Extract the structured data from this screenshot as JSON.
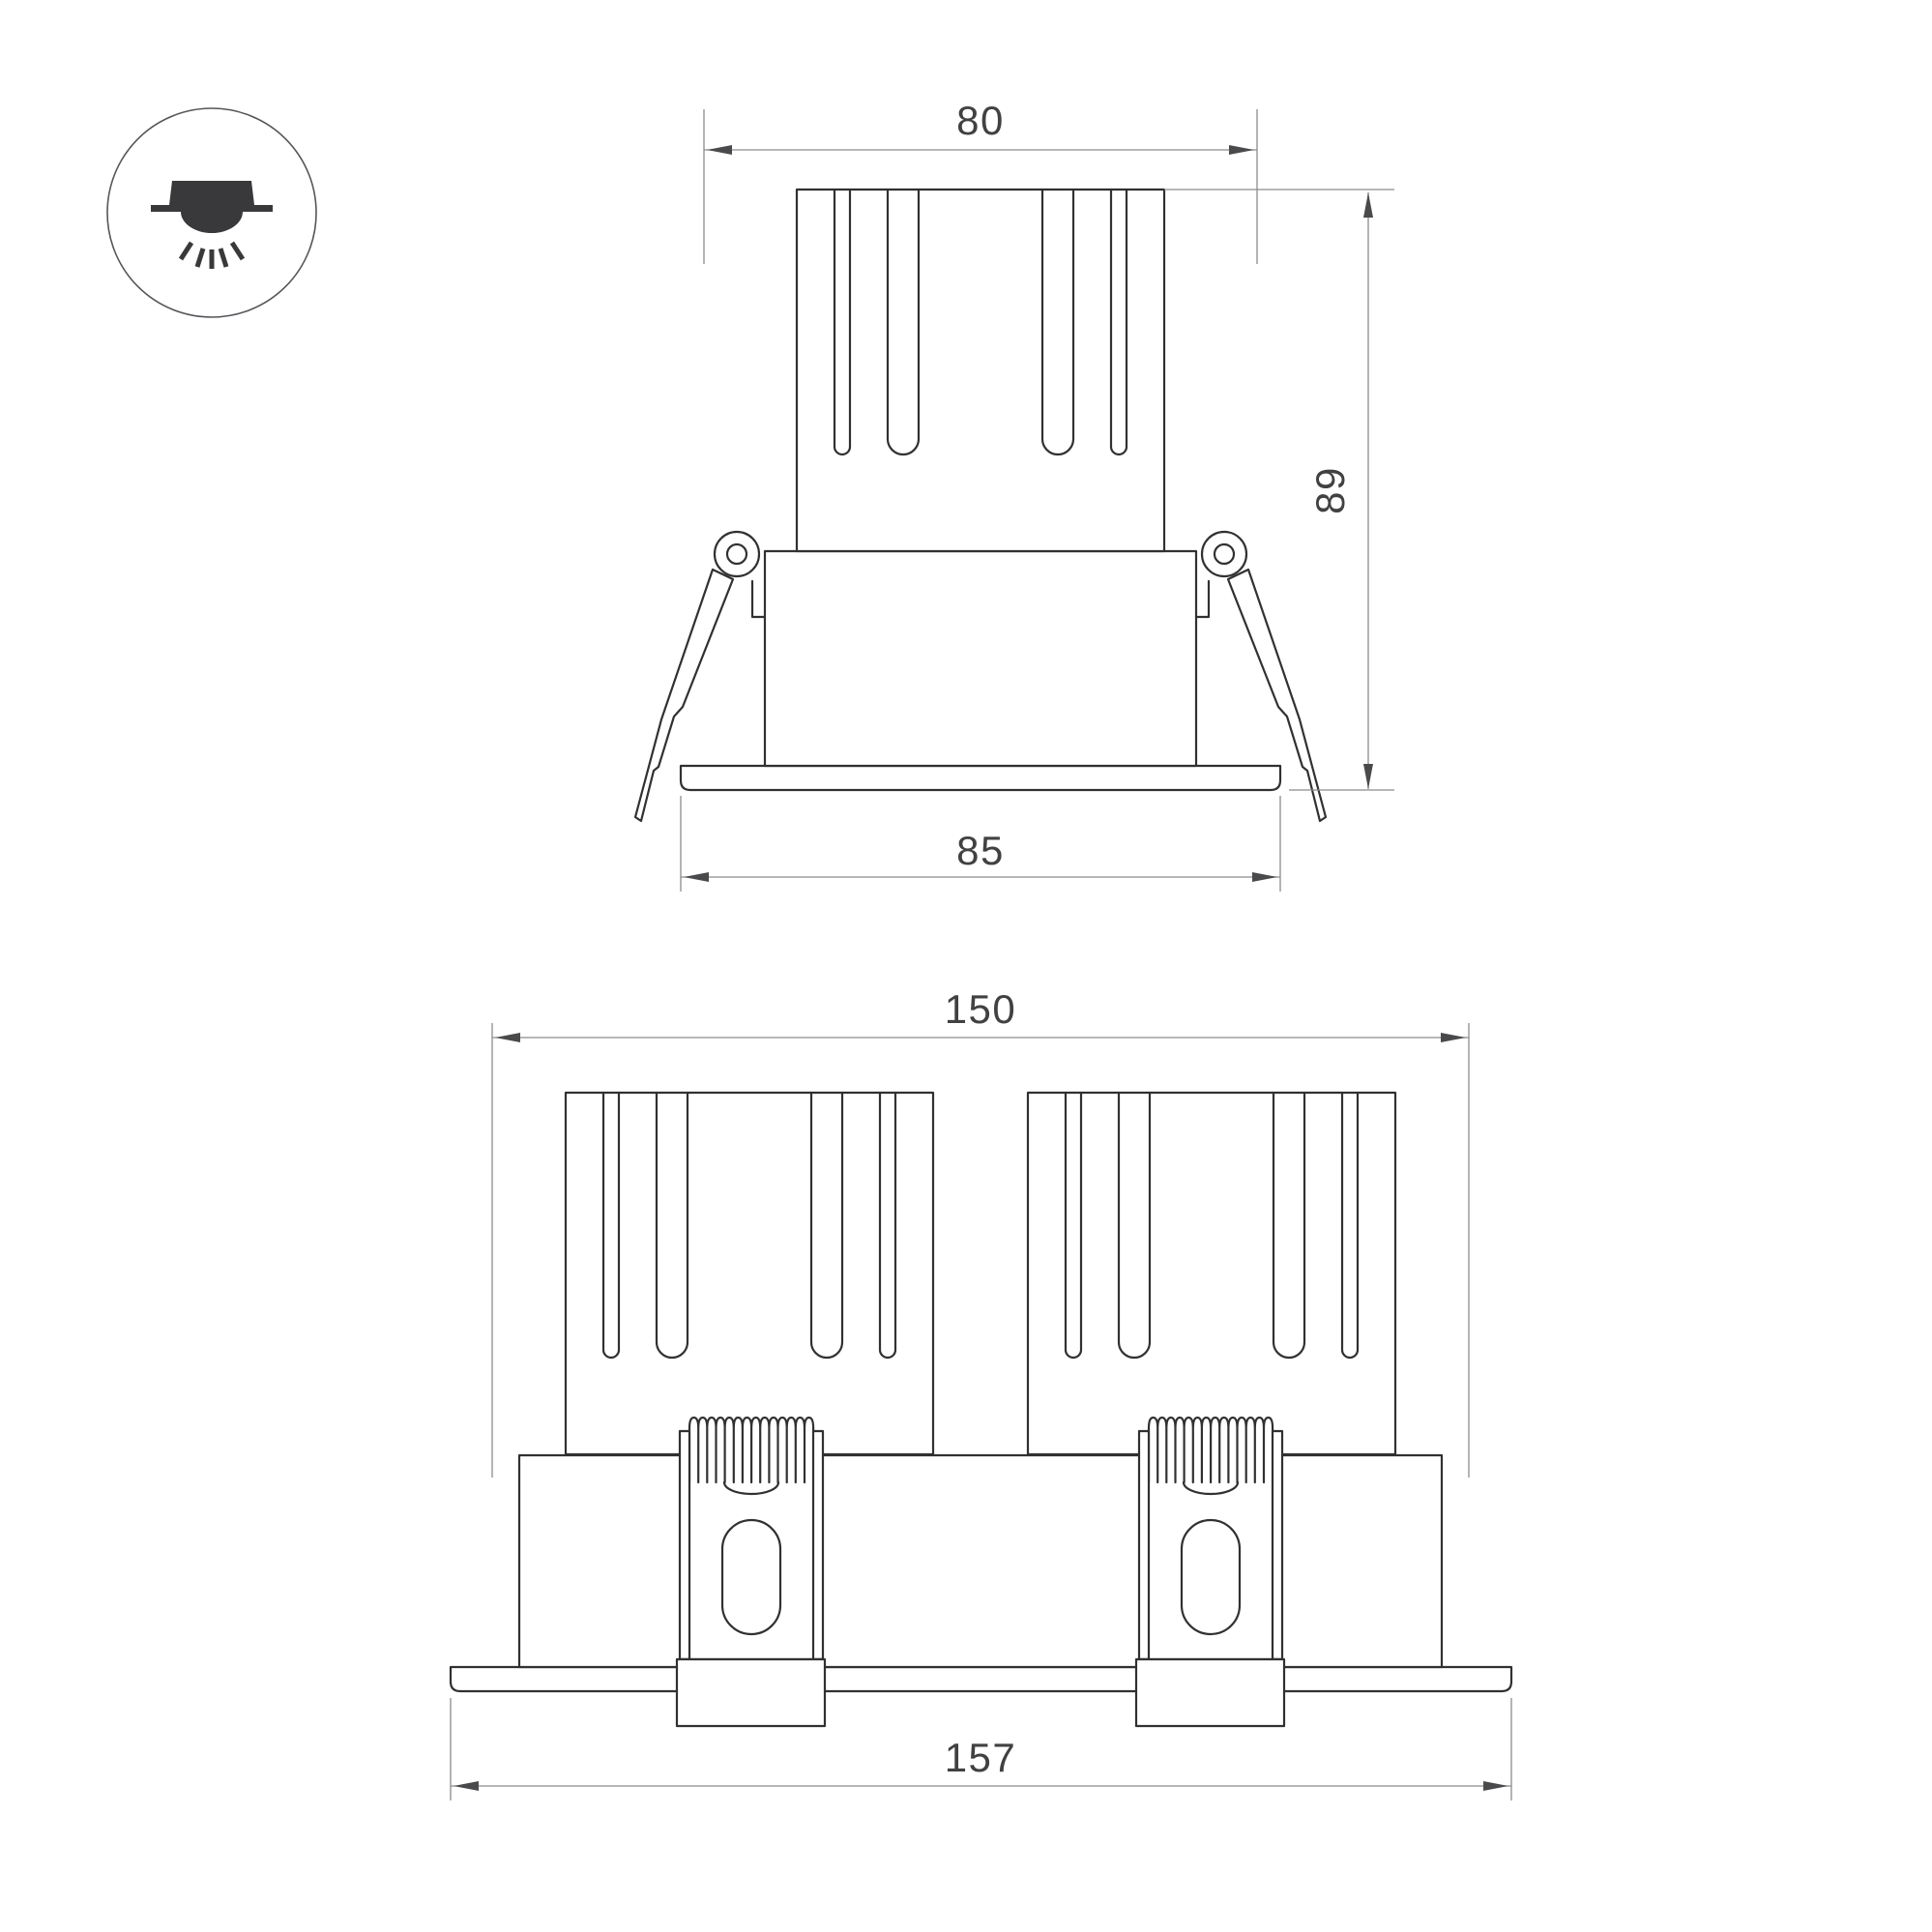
{
  "page": {
    "background": "#ffffff"
  },
  "colors": {
    "object_line": "#313133",
    "dimension_line": "#8c8c8e",
    "arrow": "#4a4a4c",
    "label_text": "#414143",
    "icon_fill": "#39393b",
    "icon_ring": "#55555a"
  },
  "icon": {
    "name": "recessed-downlight-icon"
  },
  "front_view": {
    "title": "single module front view",
    "dims": {
      "top_width": "80",
      "height": "89",
      "flange_width": "85"
    }
  },
  "double_view": {
    "title": "double module front view",
    "dims": {
      "top_width": "150",
      "flange_width": "157"
    }
  }
}
